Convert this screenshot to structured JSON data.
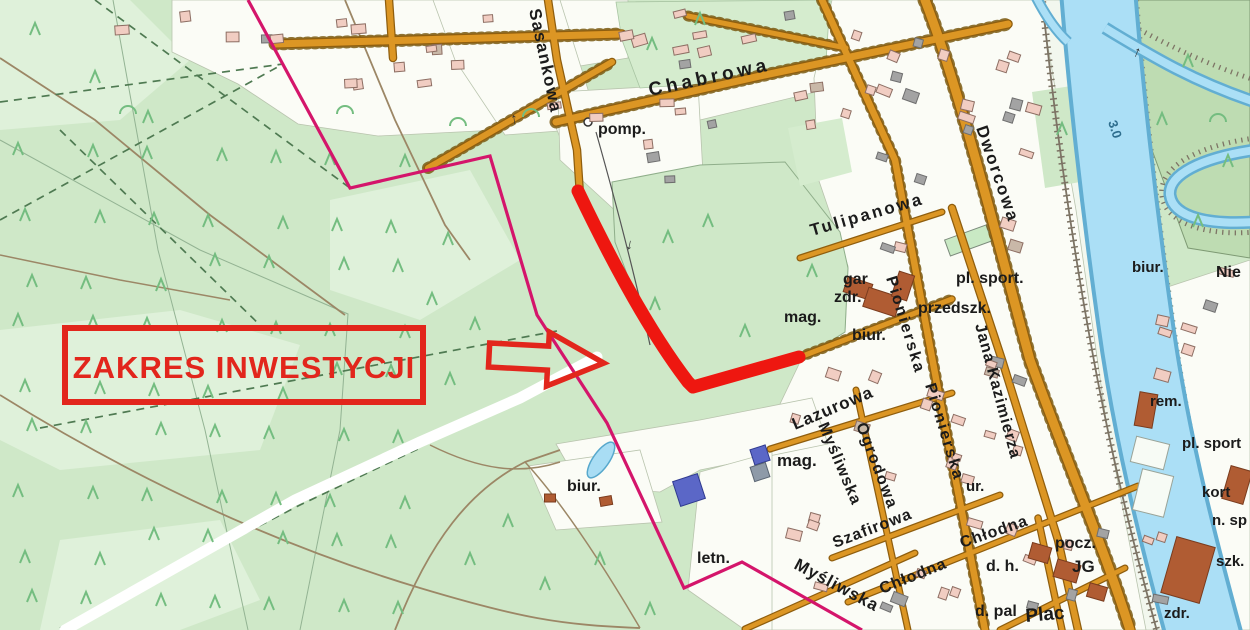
{
  "map": {
    "annotation": {
      "label": "ZAKRES INWESTYCJI"
    },
    "icons": {
      "flow_arrow": "↑",
      "pump_station": "pump-circle"
    },
    "colors": {
      "annotation_red": "#e2261c",
      "route_red": "#ee1710",
      "boundary_magenta": "#d4156b",
      "road_orange": "#dc9624",
      "water_blue": "#a9ddf4",
      "forest_green": "#cfe8c8",
      "tree_green": "#74bd80"
    },
    "labels": [
      {
        "id": "sasankowa",
        "text": "Sasankowa"
      },
      {
        "id": "chabrowa",
        "text": "Chabrowa"
      },
      {
        "id": "pomp",
        "text": "pomp."
      },
      {
        "id": "tulipanowa",
        "text": "Tulipanowa"
      },
      {
        "id": "dworcowa",
        "text": "Dworcowa"
      },
      {
        "id": "pl-sport-1",
        "text": "pl. sport."
      },
      {
        "id": "przedszk",
        "text": "przedszk."
      },
      {
        "id": "gar",
        "text": "gar"
      },
      {
        "id": "zdr-1",
        "text": "zdr."
      },
      {
        "id": "mag-1",
        "text": "mag."
      },
      {
        "id": "biur-1",
        "text": "biur."
      },
      {
        "id": "pionierska-1",
        "text": "Pionierska"
      },
      {
        "id": "pionierska-2",
        "text": "Pionierska"
      },
      {
        "id": "jana-kazimierza",
        "text": "Jana Kazimierza"
      },
      {
        "id": "biur-2",
        "text": "biur."
      },
      {
        "id": "nie",
        "text": "Nie"
      },
      {
        "id": "rem",
        "text": "rem."
      },
      {
        "id": "pl-sport-2",
        "text": "pl. sport"
      },
      {
        "id": "kort",
        "text": "kort"
      },
      {
        "id": "n-sp",
        "text": "n. sp"
      },
      {
        "id": "szk",
        "text": "szk."
      },
      {
        "id": "zdr-2",
        "text": "zdr."
      },
      {
        "id": "lazurowa",
        "text": "Lazurowa"
      },
      {
        "id": "ogrodowa",
        "text": "Ogrodowa"
      },
      {
        "id": "mysliwska-1",
        "text": "Myśliwska"
      },
      {
        "id": "szafirowa",
        "text": "Szafirowa"
      },
      {
        "id": "chlodna-1",
        "text": "Chłodna"
      },
      {
        "id": "chlodna-2",
        "text": "Chłodna"
      },
      {
        "id": "mysliwska-2",
        "text": "Myśliwska"
      },
      {
        "id": "pocz",
        "text": "pocz."
      },
      {
        "id": "jg",
        "text": "JG"
      },
      {
        "id": "d-h",
        "text": "d. h."
      },
      {
        "id": "d-pal",
        "text": "d. pal"
      },
      {
        "id": "plac",
        "text": "Plac"
      },
      {
        "id": "letn",
        "text": "letn."
      },
      {
        "id": "biur-3",
        "text": "biur."
      },
      {
        "id": "mag-2",
        "text": "mag."
      },
      {
        "id": "ur",
        "text": "ur."
      },
      {
        "id": "depth",
        "text": "3.0"
      }
    ]
  }
}
